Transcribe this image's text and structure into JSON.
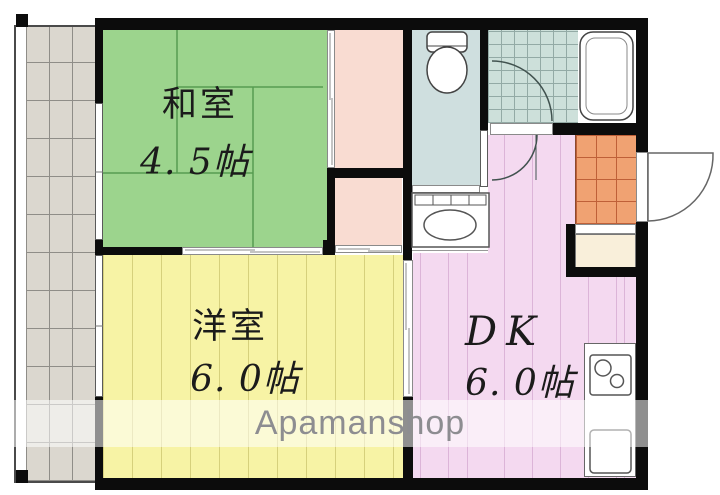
{
  "plan": {
    "type": "apartment-floorplan",
    "watermark": {
      "text": "Apamanshop",
      "color": "#8d8d91"
    },
    "rooms": {
      "washitsu": {
        "name": "和室",
        "size": "4. 5帖",
        "color": "#9cd48d"
      },
      "yoshitsu": {
        "name": "洋室",
        "size": "6. 0帖",
        "color": "#f7f3a5"
      },
      "dk": {
        "name": "DK",
        "size": "6. 0帖",
        "color": "#f4d9f0"
      }
    },
    "palette": {
      "wall": "#0c0c0c",
      "closet_salmon": "#f9dcd2",
      "toilet_floor": "#cfdfdf",
      "bath_tile": "#cde0da",
      "genkan_tile": "#f0a272",
      "balcony_floor": "#dbd7cf",
      "shoe_closet_cream": "#f9efda"
    }
  }
}
